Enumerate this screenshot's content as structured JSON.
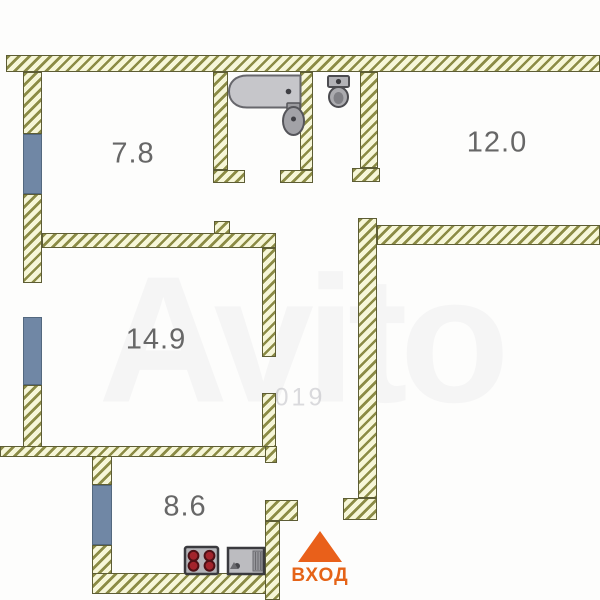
{
  "plan": {
    "rooms": [
      {
        "label": "7.8"
      },
      {
        "label": "12.0"
      },
      {
        "label": "14.9"
      },
      {
        "label": "8.6"
      }
    ],
    "entrance": {
      "label": "ВХОД"
    },
    "watermark": {
      "brand": "Avito",
      "digits": "019"
    },
    "fixtures": [
      {
        "icon": "bathtub-icon"
      },
      {
        "icon": "wash-basin-icon"
      },
      {
        "icon": "toilet-icon"
      },
      {
        "icon": "stove-icon"
      },
      {
        "icon": "kitchen-sink-icon"
      }
    ],
    "colors": {
      "wall_fill": "#f6f6d8",
      "wall_stripe": "#8b8b45",
      "wall_border": "#5d5d35",
      "window": "#7087a5",
      "accent_orange": "#e56317",
      "label_gray": "#676767"
    }
  }
}
